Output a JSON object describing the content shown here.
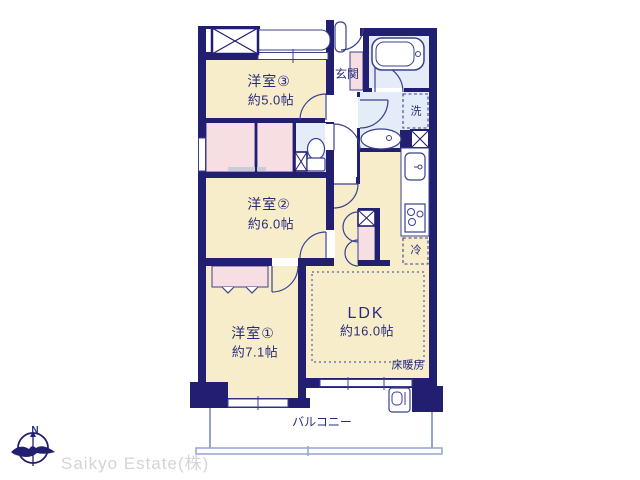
{
  "floor_plan": {
    "rooms": [
      {
        "id": "room3",
        "name": "洋室③",
        "size": "約5.0帖"
      },
      {
        "id": "room2",
        "name": "洋室②",
        "size": "約6.0帖"
      },
      {
        "id": "room1",
        "name": "洋室①",
        "size": "約7.1帖"
      },
      {
        "id": "ldk",
        "name": "LDK",
        "size": "約16.0帖"
      }
    ],
    "labels": {
      "entrance": "玄関",
      "washing_machine": "洗",
      "refrigerator": "冷",
      "floor_heating": "床暖房",
      "balcony": "バルコニー"
    },
    "colors": {
      "wall": "#221e70",
      "room_floor": "#f8edcb",
      "closet": "#f6dee3",
      "wet_area": "#e4edf7",
      "fixture_line": "#39418f",
      "balcony_line": "#96a3cf",
      "label_text": "#272d7a",
      "watermark": "#d4d4d4"
    }
  },
  "compass": {
    "north": "N"
  },
  "watermark": "Saikyo Estate(株)"
}
